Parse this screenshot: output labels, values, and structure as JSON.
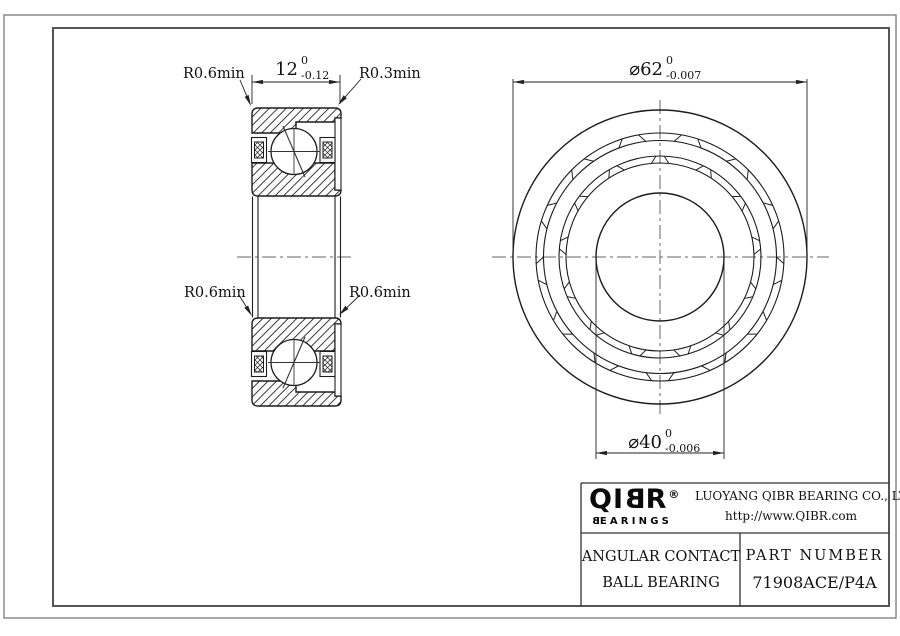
{
  "section_view": {
    "width_dim": {
      "label": "12",
      "upper": "0",
      "lower": "-0.12"
    },
    "fillet_top_left": "R0.6min",
    "fillet_top_right": "R0.3min",
    "fillet_bottom_left": "R0.6min",
    "fillet_bottom_right": "R0.6min"
  },
  "front_view": {
    "outer_dim": {
      "label": "⌀62",
      "upper": "0",
      "lower": "-0.007"
    },
    "bore_dim": {
      "label": "⌀40",
      "upper": "0",
      "lower": "-0.006"
    }
  },
  "title_block": {
    "brand": {
      "pre": "QI",
      "mirrored_letter": "B",
      "post": "R",
      "registered": "®",
      "sub_mirrored": "B",
      "sub_rest": "EARINGS"
    },
    "company": "LUOYANG QIBR BEARING CO., LTD",
    "website": "http://www.QIBR.com",
    "product": {
      "line1": "ANGULAR CONTACT",
      "line2": "BALL BEARING"
    },
    "part": {
      "label": "PART NUMBER",
      "number": "71908ACE/P4A"
    }
  },
  "colors": {
    "line": "#1c1c1c",
    "thin_line": "#333333",
    "centerline": "#666666",
    "outer_border": "#8a8a8a",
    "background": "#ffffff"
  }
}
